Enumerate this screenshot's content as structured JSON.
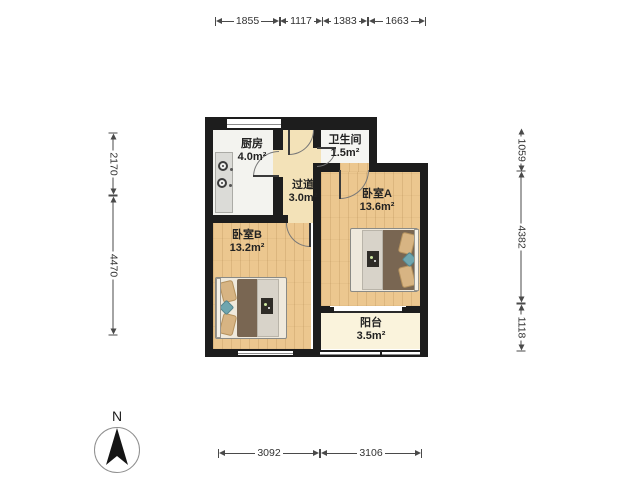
{
  "compass": {
    "north_label": "N"
  },
  "rooms": {
    "kitchen": {
      "name": "厨房",
      "area": "4.0m²"
    },
    "bathroom": {
      "name": "卫生间",
      "area": "1.5m²"
    },
    "hallway": {
      "name": "过道",
      "area": "3.0m²"
    },
    "bedroom_a": {
      "name": "卧室A",
      "area": "13.6m²"
    },
    "bedroom_b": {
      "name": "卧室B",
      "area": "13.2m²"
    },
    "balcony": {
      "name": "阳台",
      "area": "3.5m²"
    }
  },
  "dims": {
    "top": [
      "1855",
      "1117",
      "1383",
      "1663"
    ],
    "bottom": [
      "3092",
      "3106"
    ],
    "left": [
      "2170",
      "4470"
    ],
    "right": [
      "1059",
      "4382",
      "1118"
    ]
  },
  "colors": {
    "wall": "#1d1d1d",
    "wood_floor": "#ecc78f",
    "hallway_floor": "#f3e2b8",
    "tile_floor": "#f3f3ef",
    "balcony_floor": "#faf3dc",
    "duvet": "#796652",
    "pillow": "#d7b483",
    "teal_accent": "#6fa6af"
  }
}
